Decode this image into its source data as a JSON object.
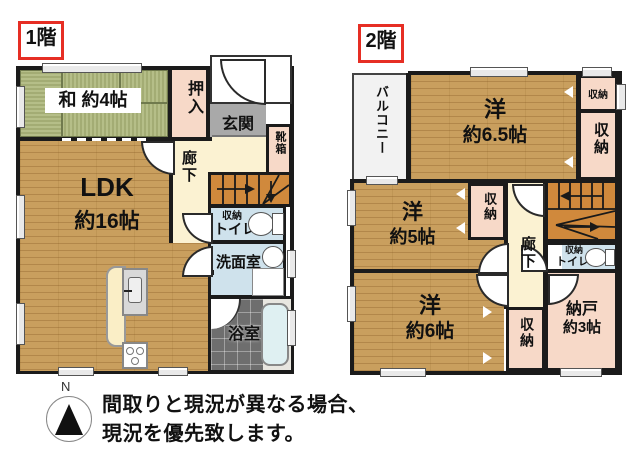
{
  "floor1": {
    "badge": "1階",
    "rooms": {
      "washitsu_label": "和 約4帖",
      "oshiire": "押入",
      "genkan": "玄関",
      "kutsubako": "靴箱",
      "rouka": "廊下",
      "ldk_name": "LDK",
      "ldk_size": "約16帖",
      "toilet_storage": "収納",
      "toilet": "トイレ",
      "senmenshitsu": "洗面室",
      "yokushitsu": "浴室"
    }
  },
  "floor2": {
    "badge": "2階",
    "rooms": {
      "balcony": "バルコニー",
      "yo65_name": "洋",
      "yo65_size": "約6.5帖",
      "storage_top": "収納",
      "storage_right": "収納",
      "yo5_name": "洋",
      "yo5_size": "約5帖",
      "storage_mid": "収納",
      "rouka": "廊下",
      "toilet_storage": "収納",
      "toilet": "トイレ",
      "nando_name": "納戸",
      "nando_size": "約3帖",
      "storage_bottom": "収納",
      "yo6_name": "洋",
      "yo6_size": "約6帖"
    }
  },
  "annotation": {
    "compass_n": "N",
    "line1": "間取りと現況が異なる場合、",
    "line2": "現況を優先致します。"
  },
  "colors": {
    "wall": "#1b1b1b",
    "wood_floor": "#c99f5e",
    "tatami": "#aeb781",
    "closet_pink": "#f7d9c8",
    "corridor_cream": "#fbf2d2",
    "wet_area_blue": "#cfe2ec",
    "genkan_gray": "#a9a9a9",
    "stairs_orange": "#d0893c",
    "badge_red": "#e62e24"
  }
}
